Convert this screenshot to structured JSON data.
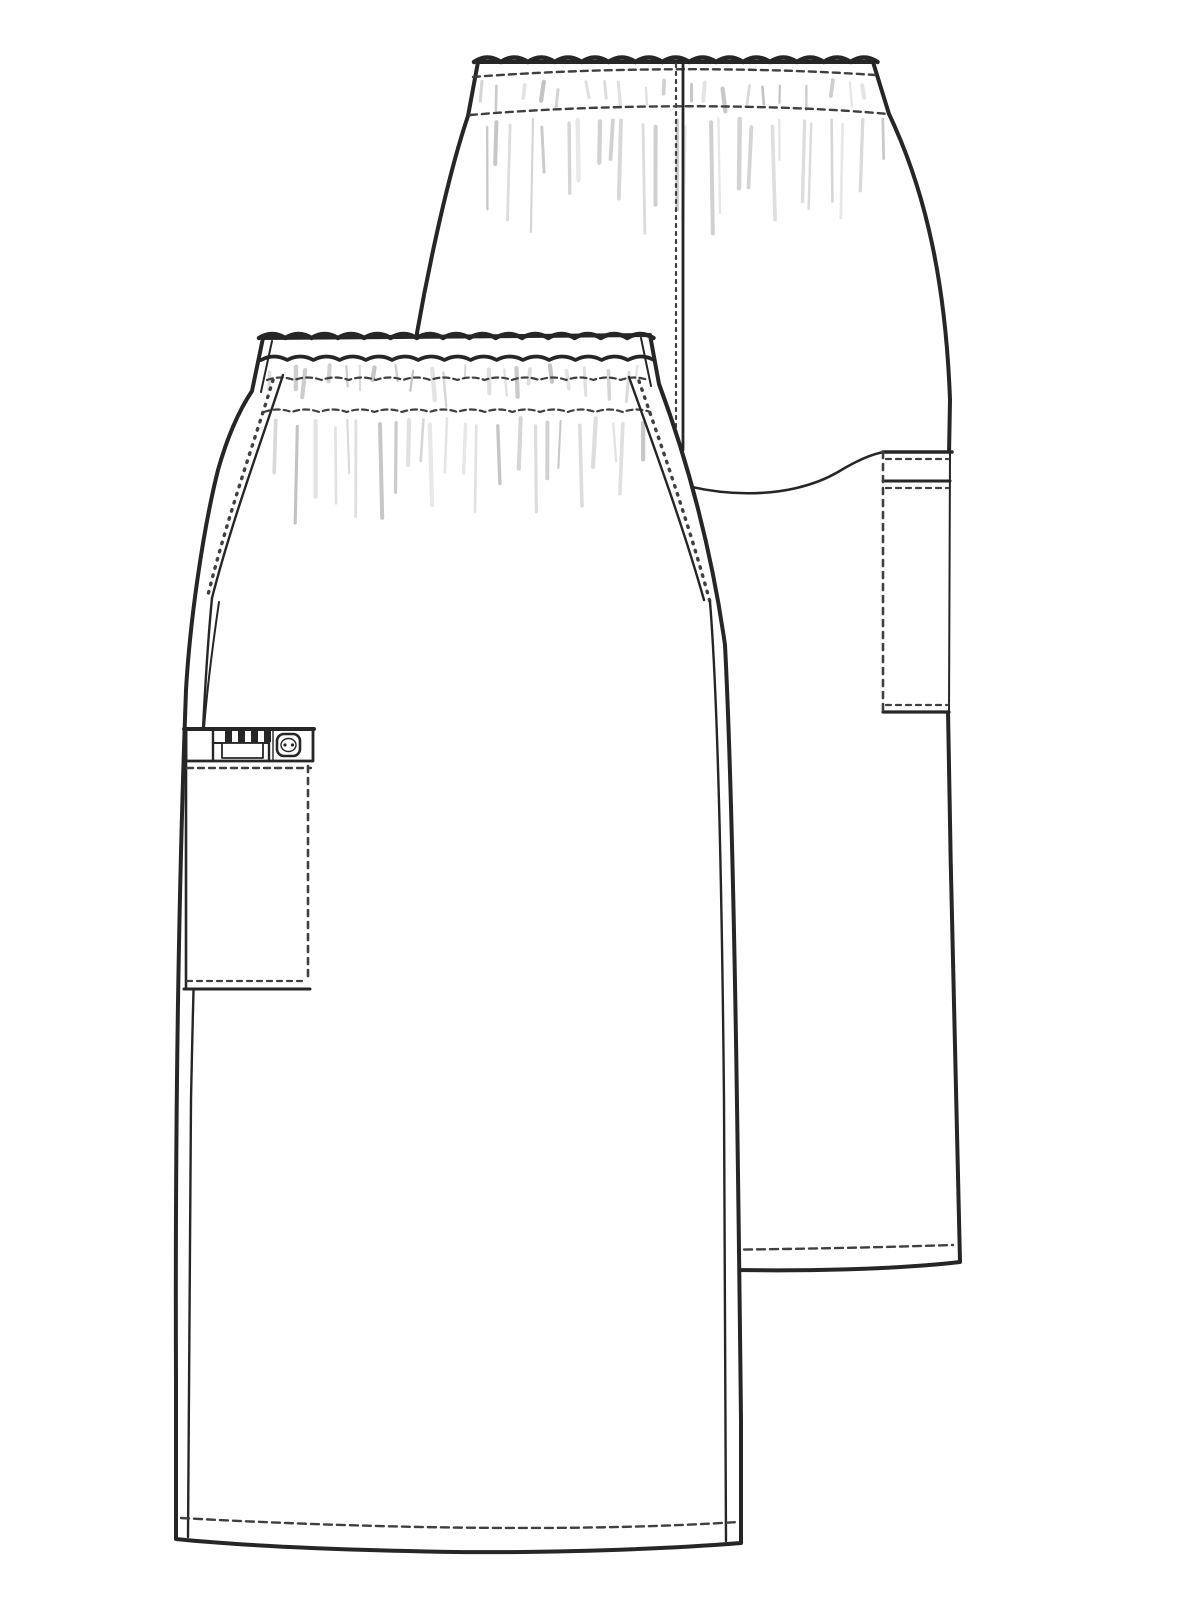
{
  "page": {
    "kind": "garment-flat-sketch",
    "description": "Black line-art technical flat sketch of an elastic-waist cargo scrub skirt, overlapping back view (upper right) and front view (lower left) on white"
  },
  "colors": {
    "paper": "#ffffff",
    "line": "#262626",
    "stitch": "#404040",
    "shade": "#b4b4b4"
  },
  "views": {
    "back": {
      "label": "back-view",
      "parts": [
        "elastic-waistband",
        "center-back-seam",
        "back-yoke-curve",
        "side-cargo-pocket",
        "hem-stitching"
      ]
    },
    "front": {
      "label": "front-view",
      "parts": [
        "elastic-waistband",
        "side-seams",
        "cargo-pocket",
        "pencil-slots",
        "button",
        "hem-stitching"
      ]
    }
  }
}
